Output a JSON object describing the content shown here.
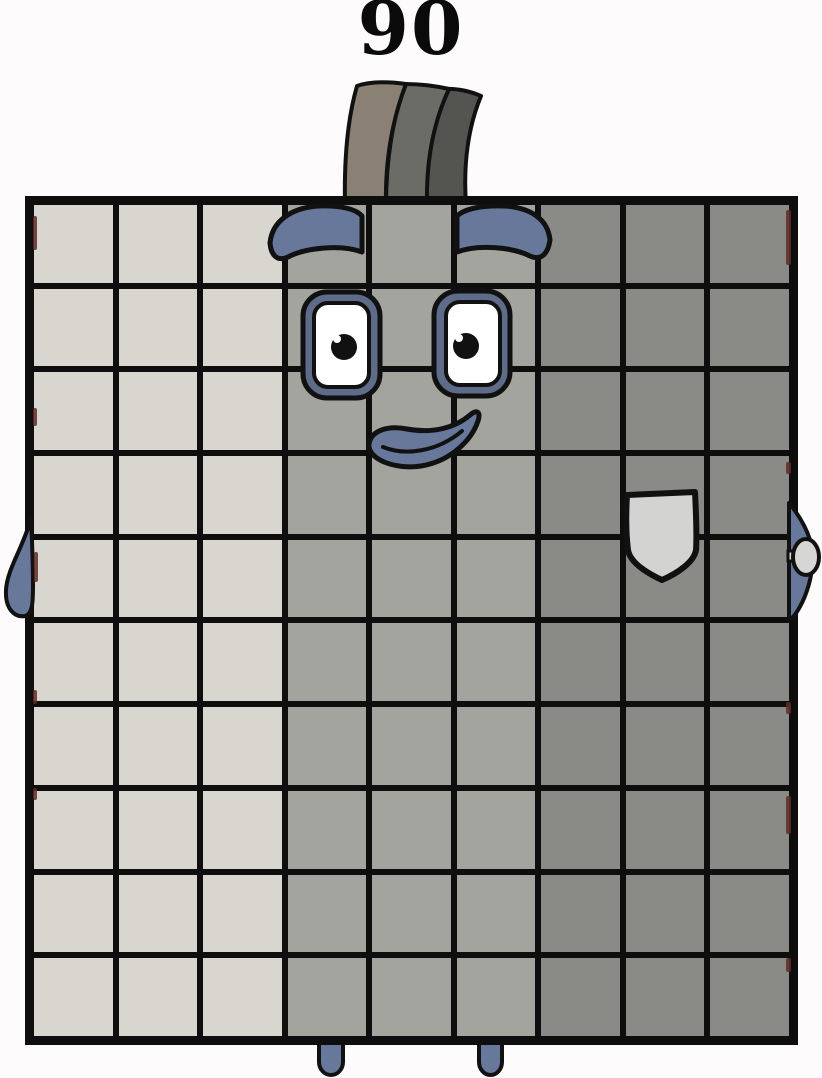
{
  "page": {
    "background": "#fdfbfb"
  },
  "character": {
    "number_label": "90",
    "grid": {
      "columns": 9,
      "rows": 10,
      "total_cells": 90,
      "column_shades": [
        "light",
        "light",
        "light",
        "medium",
        "medium",
        "medium",
        "dark",
        "dark",
        "dark"
      ]
    },
    "colors": {
      "cell_light": "#d9d6d0",
      "cell_medium": "#a3a49e",
      "cell_dark": "#8a8b87",
      "grid_line": "#0e0e0e",
      "slate": "#67789a",
      "eye_frame": "#5e6c89",
      "eye_white": "#ffffff",
      "pupil": "#111111",
      "pocket": "#d3d4d2",
      "hand_object": "#d6d7d5",
      "hat_front": "#8a8174",
      "hat_middle": "#6b6c66",
      "hat_back": "#545551",
      "number_text": "#0a0a0a",
      "edge_artifact": "#5f2b28"
    },
    "artifacts": [
      {
        "x": 33,
        "y": 216,
        "w": 4,
        "h": 34
      },
      {
        "x": 33,
        "y": 408,
        "w": 4,
        "h": 18
      },
      {
        "x": 34,
        "y": 552,
        "w": 4,
        "h": 30
      },
      {
        "x": 33,
        "y": 690,
        "w": 4,
        "h": 14
      },
      {
        "x": 33,
        "y": 788,
        "w": 4,
        "h": 12
      },
      {
        "x": 786,
        "y": 210,
        "w": 5,
        "h": 55
      },
      {
        "x": 786,
        "y": 462,
        "w": 5,
        "h": 12
      },
      {
        "x": 786,
        "y": 702,
        "w": 5,
        "h": 12
      },
      {
        "x": 786,
        "y": 796,
        "w": 5,
        "h": 38
      },
      {
        "x": 786,
        "y": 958,
        "w": 5,
        "h": 14
      }
    ]
  }
}
